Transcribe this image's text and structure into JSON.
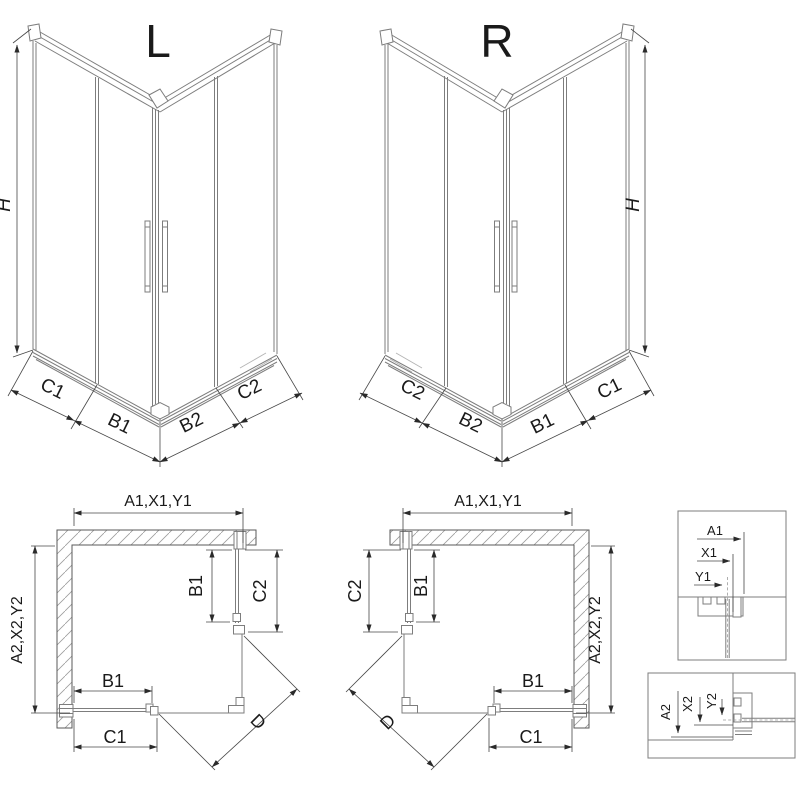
{
  "views": {
    "iso_left": {
      "title": "L",
      "height": "H",
      "widths": [
        "C1",
        "B1",
        "B2",
        "C2"
      ]
    },
    "iso_right": {
      "title": "R",
      "height": "H",
      "widths": [
        "C2",
        "B2",
        "B1",
        "C1"
      ]
    },
    "plan_left": {
      "top": "A1,X1,Y1",
      "side": "A2,X2,Y2",
      "door_vertical": "B1",
      "panel_vertical": "C2",
      "door_horizontal": "B1",
      "panel_horizontal": "C1",
      "diagonal": "D"
    },
    "plan_right": {
      "top": "A1,X1,Y1",
      "side": "A2,X2,Y2",
      "door_vertical": "B1",
      "panel_vertical": "C2",
      "door_horizontal": "B1",
      "panel_horizontal": "C1",
      "diagonal": "D"
    },
    "detail_top": {
      "dims": [
        "A1",
        "X1",
        "Y1"
      ]
    },
    "detail_bottom": {
      "dims": [
        "A2",
        "X2",
        "Y2"
      ]
    }
  },
  "colors": {
    "background": "#ffffff",
    "geometry_line": "#7d7d7d",
    "dimension_line": "#474747",
    "text": "#1a1a1a",
    "hatch": "#9d9d9d"
  }
}
